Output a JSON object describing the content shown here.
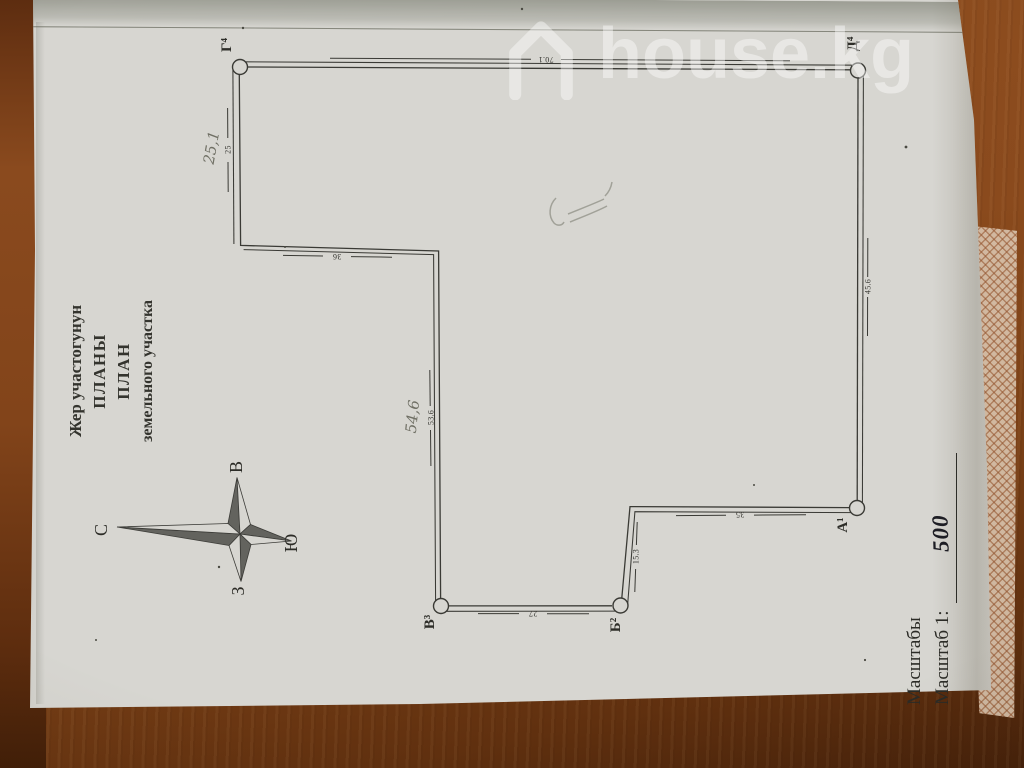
{
  "watermark": {
    "brand": "house.kg"
  },
  "title_block": {
    "line1": "Жер участогунун",
    "line2": "ПЛАНЫ",
    "line3": "ПЛАН",
    "line4": "земельного участка"
  },
  "compass": {
    "north": "С",
    "south": "Ю",
    "east": "В",
    "west": "З"
  },
  "plan": {
    "nodes": {
      "g": "Г⁴",
      "d": "Д⁴",
      "a": "А¹",
      "b": "Б²",
      "v": "В³"
    },
    "dims": {
      "top": "70.1",
      "right": "45.6",
      "notch_top": "35",
      "notch_side": "15.3",
      "bottom": "27",
      "left_lower": "53.6",
      "step": "36",
      "left_upper": "25"
    },
    "handwritten": {
      "left_upper": "25,1",
      "left_lower": "54,6"
    }
  },
  "scale_block": {
    "label1": "Масштабы",
    "label2": "Масштаб 1:",
    "value": "500"
  }
}
